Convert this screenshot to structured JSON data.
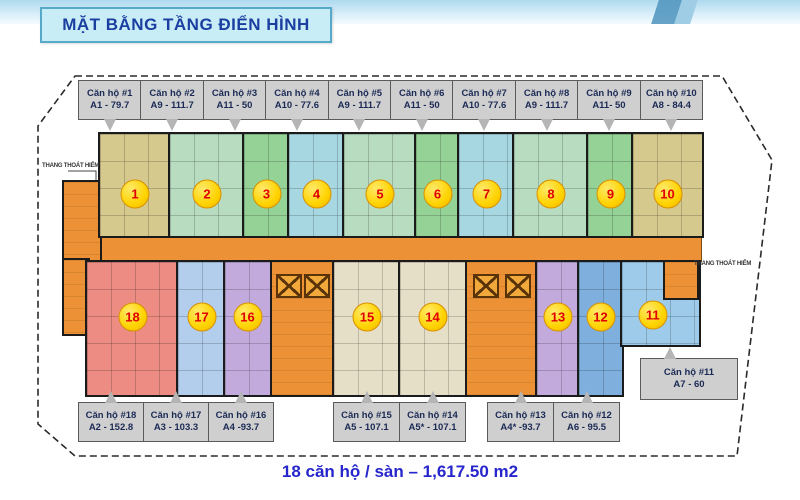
{
  "title": "MẶT BẰNG TẦNG ĐIỂN HÌNH",
  "summary": "18 căn hộ / sàn – 1,617.50 m2",
  "fire_escape_label": "THANG THOÁT HIỂM",
  "colors": {
    "corridor": "#ec9135",
    "circle_bg": "#ffd300",
    "circle_text": "#e00000",
    "callout_bg": "#cfcfcf",
    "title_text": "#1b3fa0",
    "summary_text": "#2626cc"
  },
  "units": [
    {
      "number": "1",
      "label": "Căn hộ #1",
      "area": "A1 - 79.7",
      "color": "#d6c98e"
    },
    {
      "number": "2",
      "label": "Căn hộ #2",
      "area": "A9 - 111.7",
      "color": "#b7dcc0"
    },
    {
      "number": "3",
      "label": "Căn hộ #3",
      "area": "A11 - 50",
      "color": "#94d295"
    },
    {
      "number": "4",
      "label": "Căn hộ #4",
      "area": "A10 - 77.6",
      "color": "#a7d8e2"
    },
    {
      "number": "5",
      "label": "Căn hộ #5",
      "area": "A9 - 111.7",
      "color": "#b7dcc0"
    },
    {
      "number": "6",
      "label": "Căn hộ #6",
      "area": "A11 - 50",
      "color": "#94d295"
    },
    {
      "number": "7",
      "label": "Căn hộ #7",
      "area": "A10 - 77.6",
      "color": "#a7d8e2"
    },
    {
      "number": "8",
      "label": "Căn hộ #8",
      "area": "A9 - 111.7",
      "color": "#b7dcc0"
    },
    {
      "number": "9",
      "label": "Căn hộ #9",
      "area": "A11- 50",
      "color": "#94d295"
    },
    {
      "number": "10",
      "label": "Căn hộ #10",
      "area": "A8 - 84.4",
      "color": "#d6c98e"
    },
    {
      "number": "11",
      "label": "Căn hộ #11",
      "area": "A7 - 60",
      "color": "#9ecbe9"
    },
    {
      "number": "12",
      "label": "Căn hộ #12",
      "area": "A6 - 95.5",
      "color": "#7fb0dd"
    },
    {
      "number": "13",
      "label": "Căn hộ #13",
      "area": "A4* -93.7",
      "color": "#c2abdc"
    },
    {
      "number": "14",
      "label": "Căn hộ #14",
      "area": "A5* - 107.1",
      "color": "#e6dfc8"
    },
    {
      "number": "15",
      "label": "Căn hộ #15",
      "area": "A5 - 107.1",
      "color": "#e6dfc8"
    },
    {
      "number": "16",
      "label": "Căn hộ #16",
      "area": "A4 -93.7",
      "color": "#c2abdc"
    },
    {
      "number": "17",
      "label": "Căn hộ #17",
      "area": "A3 - 103.3",
      "color": "#b3cdec"
    },
    {
      "number": "18",
      "label": "Căn hộ #18",
      "area": "A2 - 152.8",
      "color": "#ec8c82"
    }
  ]
}
